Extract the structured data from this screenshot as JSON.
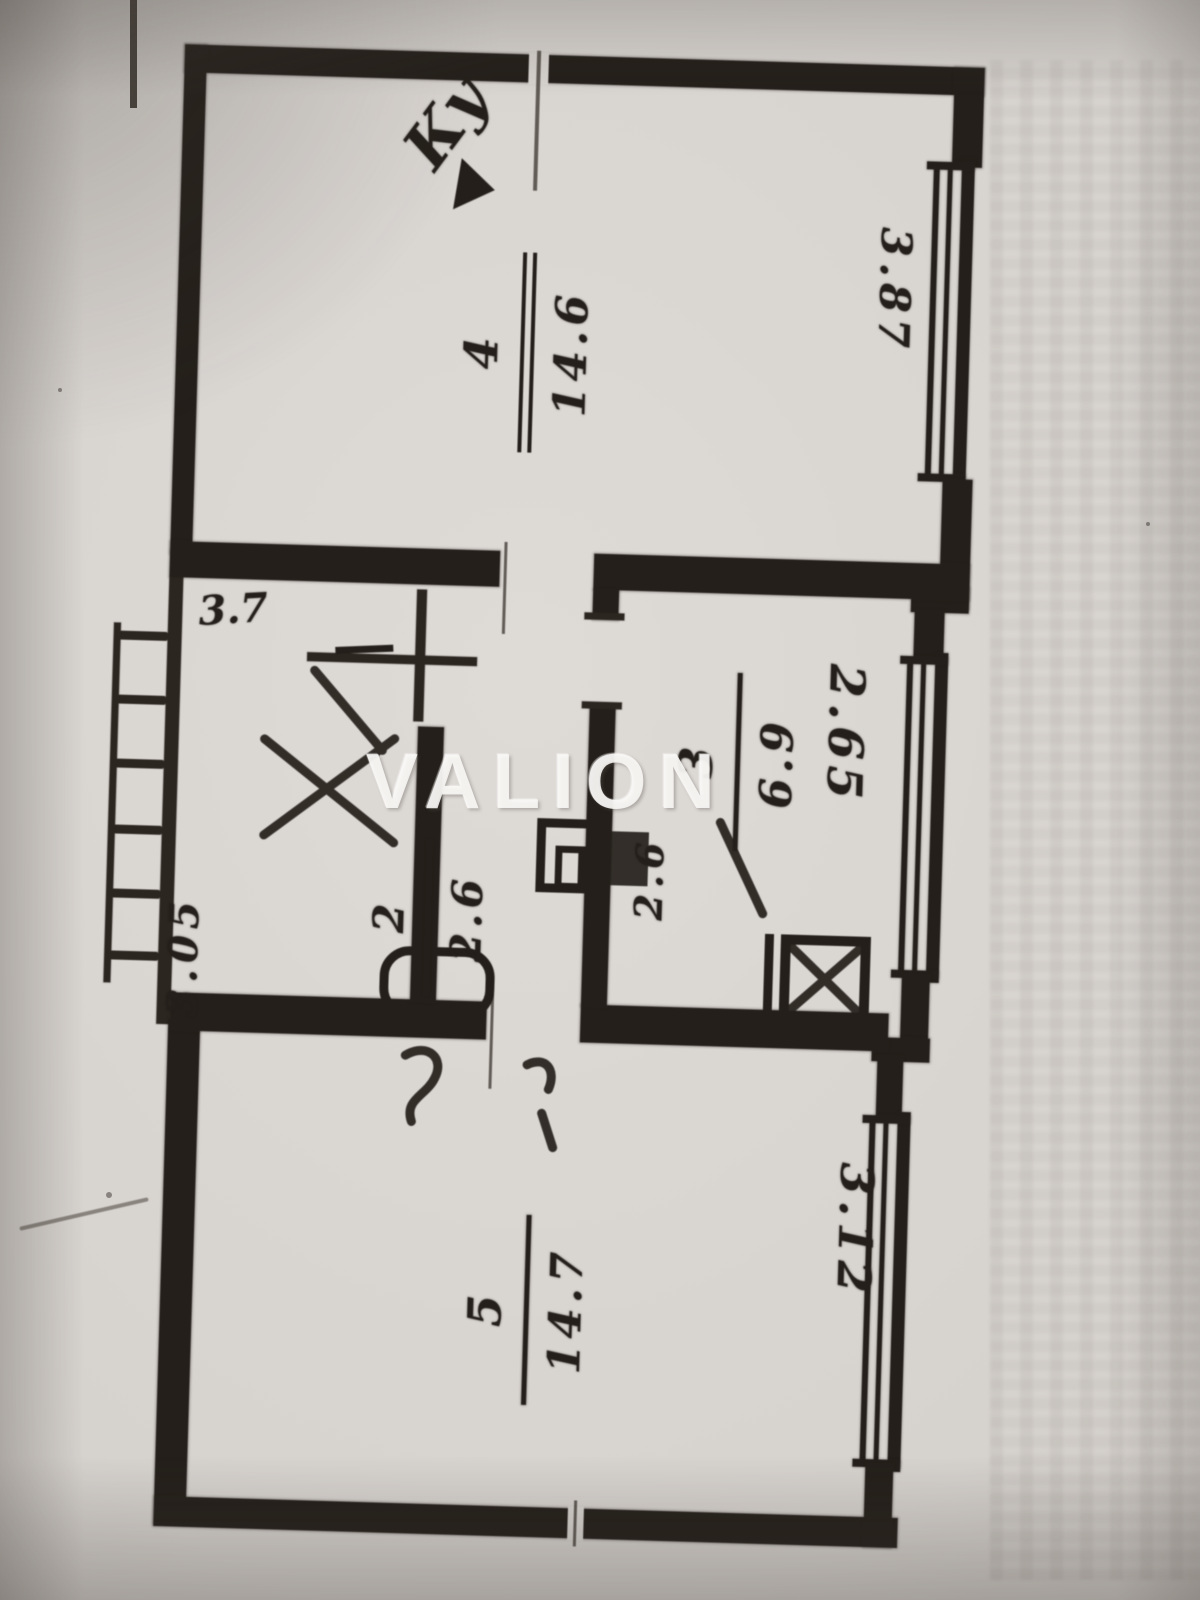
{
  "watermark": {
    "text": "VALION"
  },
  "colors": {
    "paper": "#d8d4d0",
    "ink": "#241f1a",
    "watermark": "#faf9f7"
  },
  "plan": {
    "rooms": [
      {
        "name": "top-room",
        "number": "4",
        "area": "14.6"
      },
      {
        "name": "kitchen",
        "number": "3",
        "area": "6.9"
      },
      {
        "name": "bathroom",
        "number": "2",
        "area": "2.6"
      },
      {
        "name": "bottom-room",
        "number": "5",
        "area": "14.7"
      }
    ],
    "dimensions": [
      {
        "location": "top-room-window",
        "value": "3.87"
      },
      {
        "location": "kitchen-window",
        "value": "2.65"
      },
      {
        "location": "bottom-room-window",
        "value": "3.12"
      },
      {
        "location": "left-wall",
        "value": "3.05"
      },
      {
        "location": "corridor",
        "value": "3.7"
      },
      {
        "location": "wc",
        "value": "2.6"
      }
    ],
    "annotations": [
      {
        "location": "top-wall",
        "text": "Ку"
      }
    ]
  }
}
